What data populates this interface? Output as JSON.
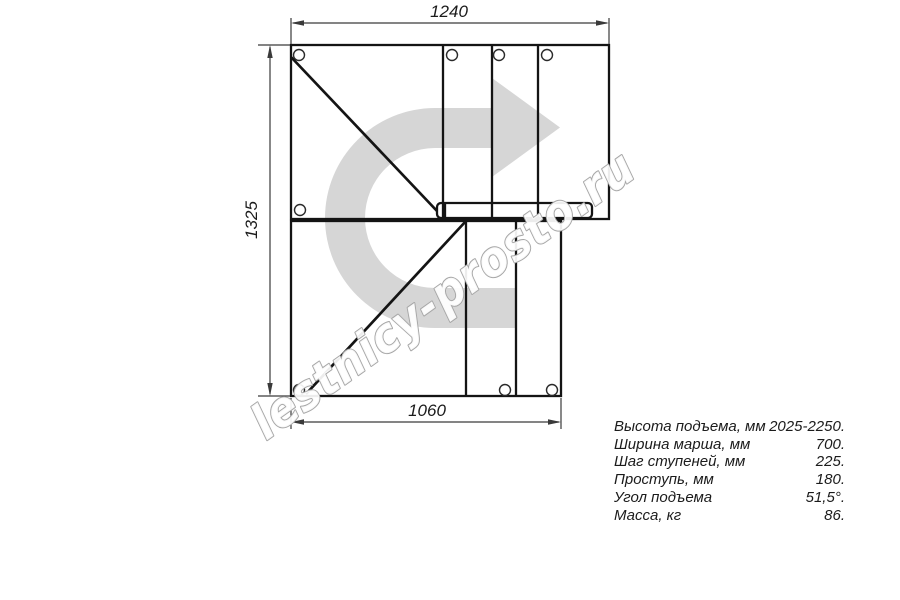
{
  "drawing": {
    "title": "staircase plan top view",
    "dim_top": "1240",
    "dim_left": "1325",
    "dim_bottom": "1060",
    "watermark": "lestnicy-prosto.ru",
    "direction_arrow": "u-turn-right-arrow"
  },
  "specs": {
    "rows": [
      {
        "label": "Высота подъема, мм",
        "value": "2025-2250."
      },
      {
        "label": "Ширина марша, мм",
        "value": "700."
      },
      {
        "label": "Шаг ступеней, мм",
        "value": "225."
      },
      {
        "label": "Проступь, мм",
        "value": "180."
      },
      {
        "label": "Угол подъема",
        "value": "51,5°."
      },
      {
        "label": "Масса, кг",
        "value": "86."
      }
    ]
  },
  "colors": {
    "line": "#141414",
    "dimension": "#3a3a3a",
    "arrow_fill": "#d6d6d6",
    "watermark_outline": "#a6a6a6",
    "text": "#1b1b1b",
    "background": "#ffffff"
  }
}
